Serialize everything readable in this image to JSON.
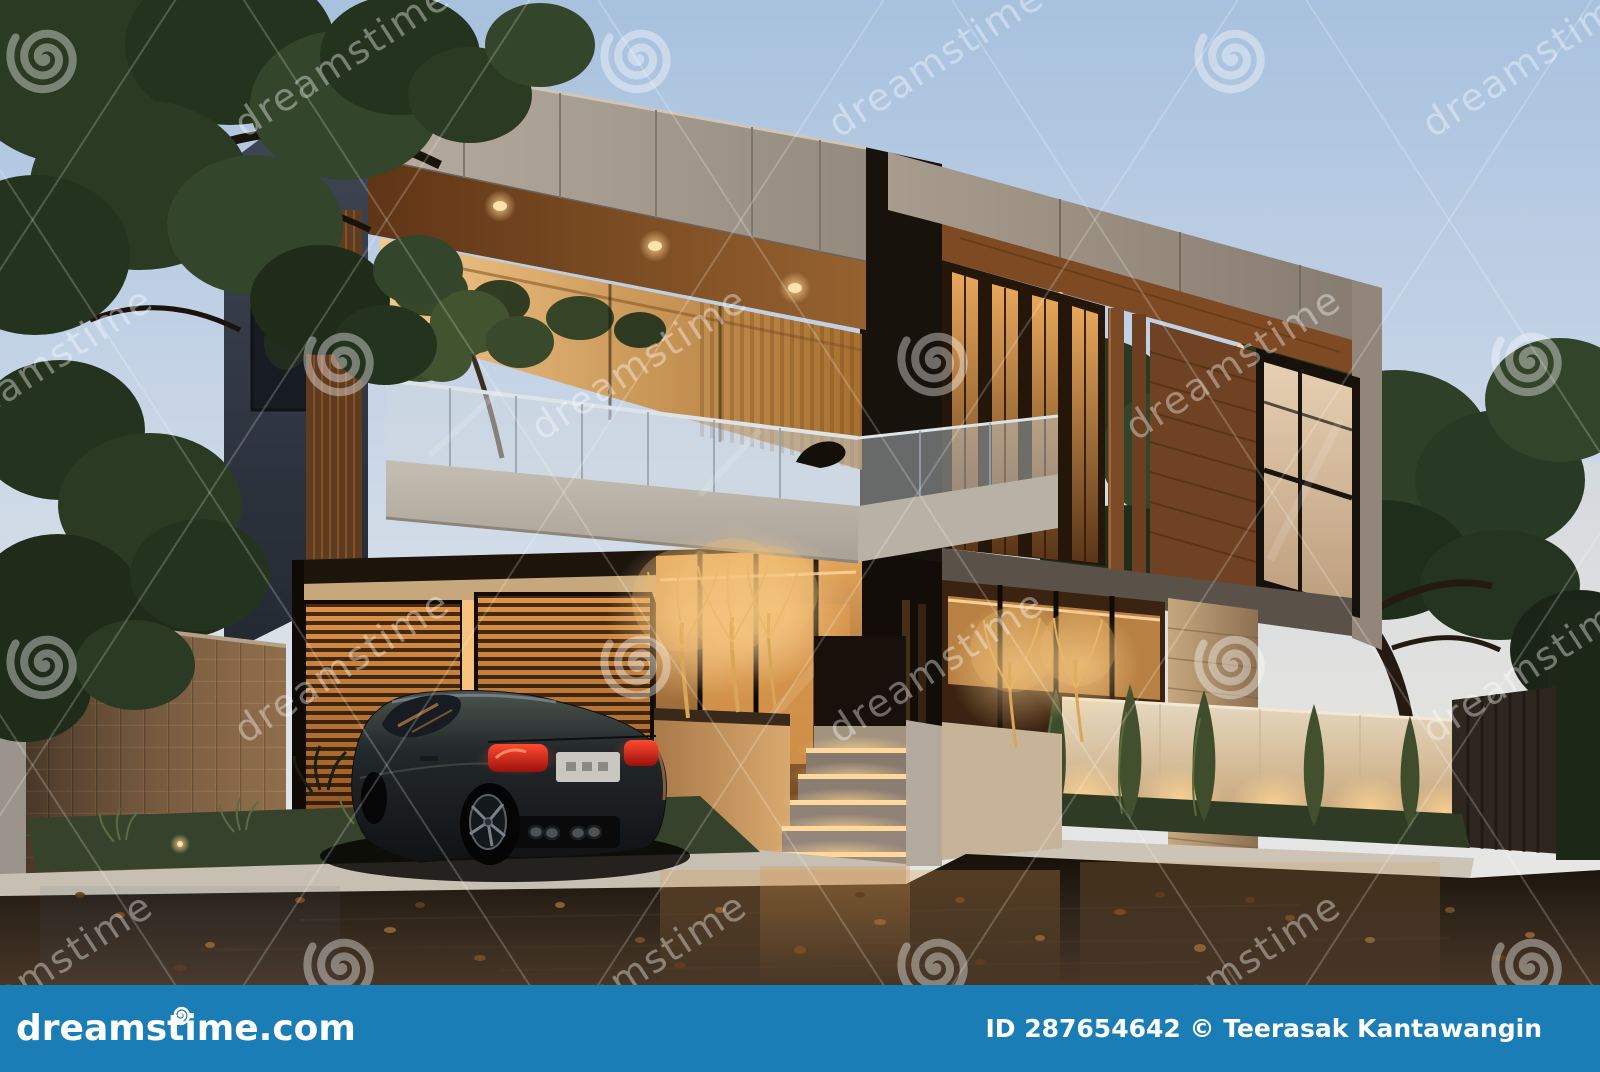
{
  "watermark": {
    "text": "dreamstime",
    "color": "#ffffff",
    "tile_opacity": 0.38,
    "grid": {
      "x_start": 45,
      "y_start": 60,
      "x_step": 297,
      "y_step": 303,
      "rows": 4,
      "cols": 6
    }
  },
  "footer": {
    "bar_color": "#1a7db6",
    "logo_text": "dreamstime.com",
    "credit_text": "ID 287654642 © Teerasak Kantawangin"
  },
  "scene": {
    "subject": "Modern two-storey luxury house at dusk with warm interior lighting, dark sports coupe parked on wet asphalt street, illuminated steps, glowing trees and landscaped fence walls",
    "palette": {
      "sky_top": "#a7c1de",
      "sky_horizon": "#ece9e2",
      "concrete_fascia": "#a89e92",
      "wood": "#8a5a30",
      "interior_glow": "#f0b468",
      "asphalt": "#241c13",
      "foliage": "#2c3c26",
      "taillight_red": "#e03a28",
      "led_strip": "#ffd9a0",
      "fence_cream": "#ddd0b9",
      "stone_pillar": "#b1926c",
      "car_body": "#23282a"
    }
  }
}
